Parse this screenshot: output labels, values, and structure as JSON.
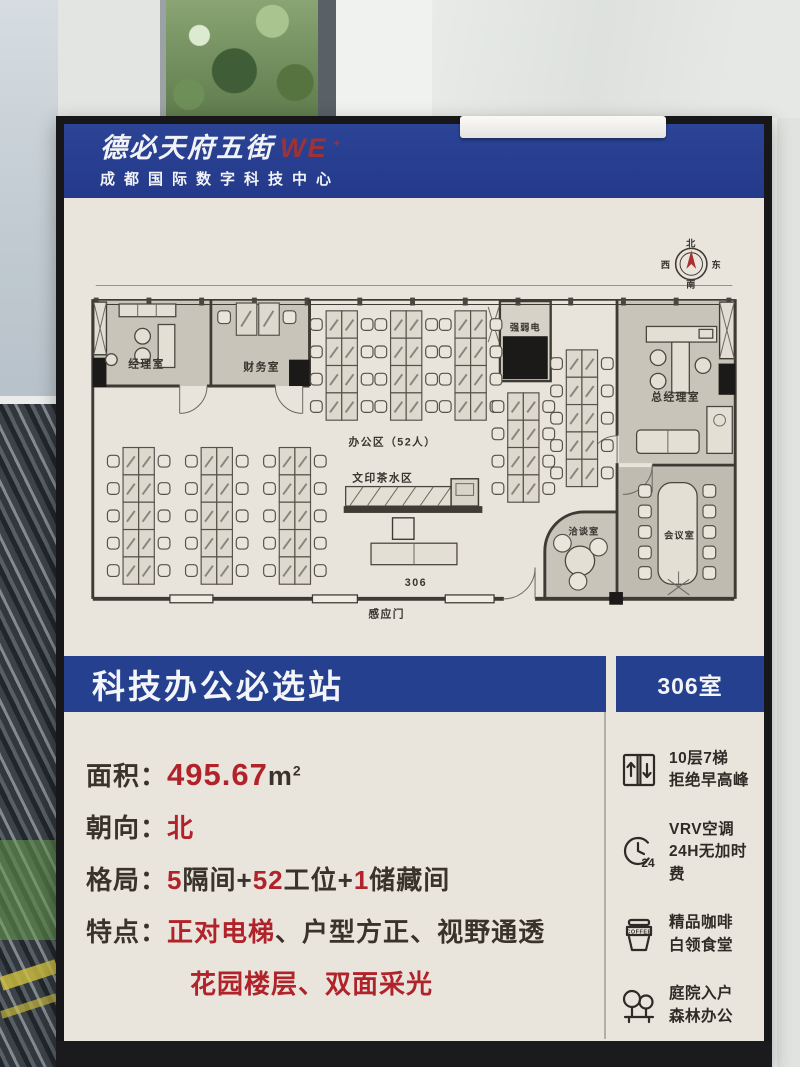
{
  "poster": {
    "header": {
      "brand": "德必天府五街",
      "brand_logo": "WE",
      "brand_logo_sup": "+",
      "subtitle": "成都国际数字科技中心"
    },
    "floorplan": {
      "compass": {
        "n": "北",
        "e": "东",
        "s": "南",
        "w": "西"
      },
      "rooms": {
        "manager": "经理室",
        "finance": "财务室",
        "office_area": "办公区（52人）",
        "utility": "强弱电",
        "gm": "总经理室",
        "print_tea": "文印茶水区",
        "talk": "洽谈室",
        "meeting": "会议室"
      },
      "labels": {
        "room_no": "306",
        "sensor_door": "感应门"
      }
    },
    "banner": {
      "title": "科技办公必选站",
      "room": "306室"
    },
    "details": {
      "area": {
        "label": "面积：",
        "value": "495.67",
        "unit": "m",
        "sup": "2"
      },
      "orientation": {
        "label": "朝向：",
        "value": "北"
      },
      "layout": {
        "label": "格局：",
        "n1": "5",
        "t1": "隔间",
        "p1": "+",
        "n2": "52",
        "t2": "工位",
        "p2": "+",
        "n3": "1",
        "t3": "储藏间"
      },
      "features": {
        "label": "特点：",
        "f1": "正对电梯",
        "s1": "、",
        "f2": "户型方正",
        "s2": "、",
        "f3": "视野通透",
        "f4": "花园楼层",
        "s3": "、",
        "f5": "双面采光"
      }
    },
    "amenities": [
      {
        "icon": "elevator",
        "line1": "10层7梯",
        "line2": "拒绝早高峰"
      },
      {
        "icon": "clock-24",
        "badge": "24",
        "line1": "VRV空调",
        "line2": "24H无加时费"
      },
      {
        "icon": "coffee",
        "cup_text": "COFFEE",
        "line1": "精品咖啡",
        "line2": "白领食堂"
      },
      {
        "icon": "trees",
        "line1": "庭院入户",
        "line2": "森林办公"
      }
    ],
    "colors": {
      "brand_blue": "#24408f",
      "accent_red": "#b0232a",
      "logo_red": "#9c3338",
      "poster_bg": "#e9e5dc",
      "room_gray": "#c8c4ba"
    }
  }
}
